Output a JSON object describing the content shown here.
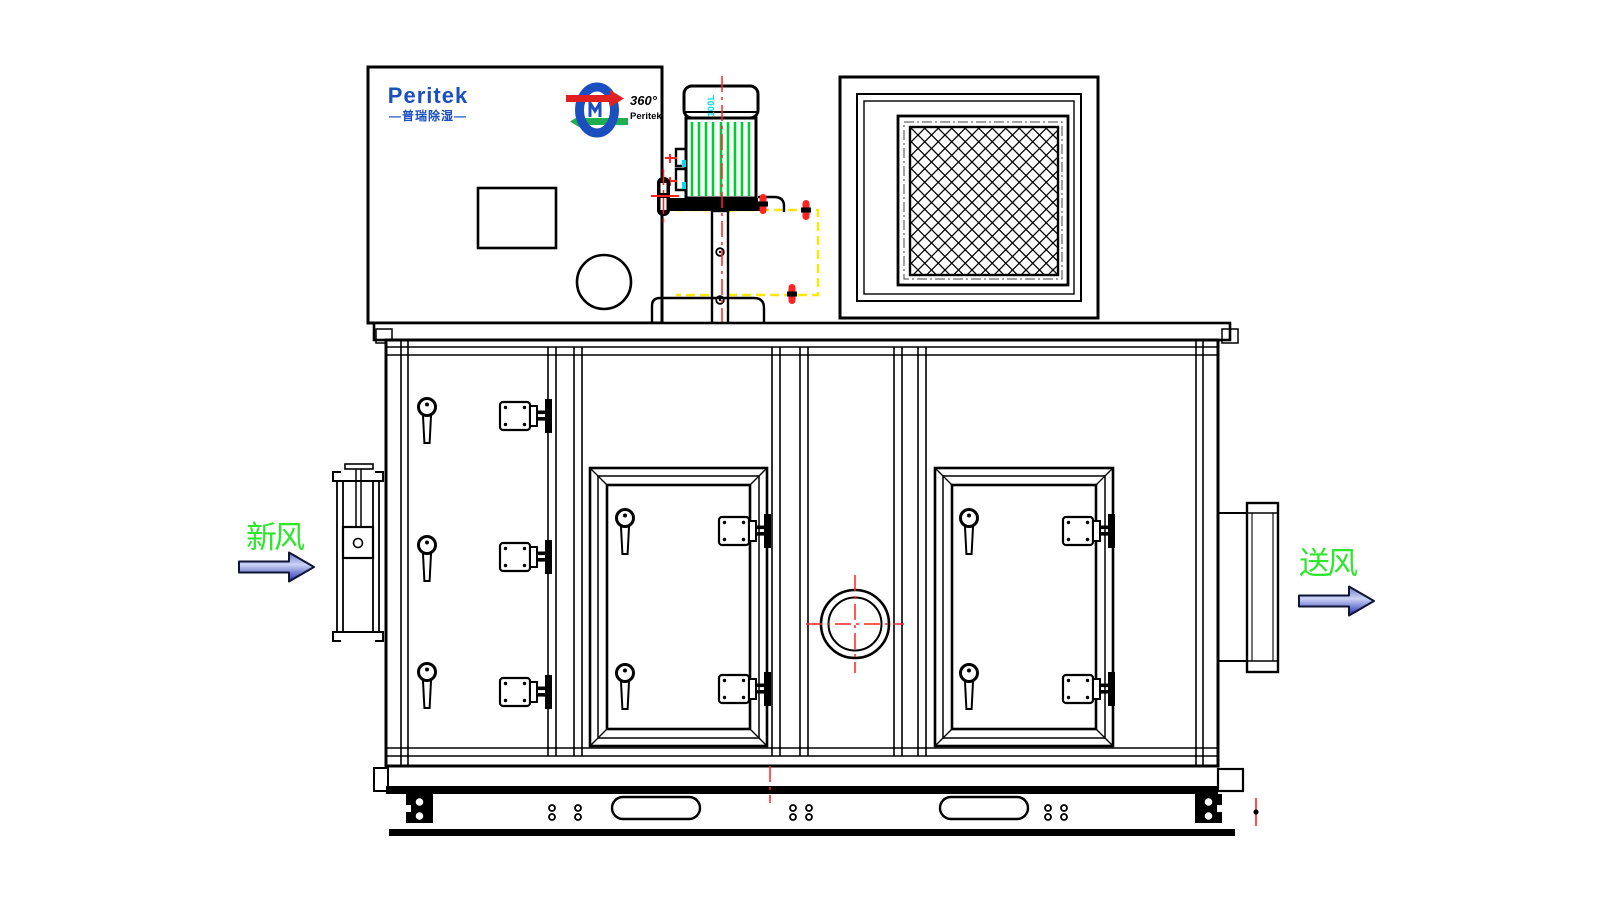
{
  "drawing": {
    "brand": {
      "logo_text": "Peritek",
      "logo_subtext": "—普瑞除湿—",
      "rotor_badge": {
        "angle_text": "360°",
        "brand_text": "Peritek"
      }
    },
    "motor": {
      "model_label": "D100L"
    },
    "airflow_labels": {
      "fresh_air": "新风",
      "supply_air": "送风"
    },
    "colors": {
      "logo_blue": "#1b4fc0",
      "label_green": "#2ee62e",
      "fin_green": "#00cc33",
      "centerline_red": "#ff2222",
      "hidden_yellow": "#ffe800",
      "cyan": "#00dde8",
      "arrow_red": "#e02020",
      "arrow_green": "#1fae4f",
      "arrow_fill_light": "#ccd3f5",
      "arrow_fill_mid": "#6677d0",
      "arrow_fill_dark": "#1f2cb0"
    }
  }
}
